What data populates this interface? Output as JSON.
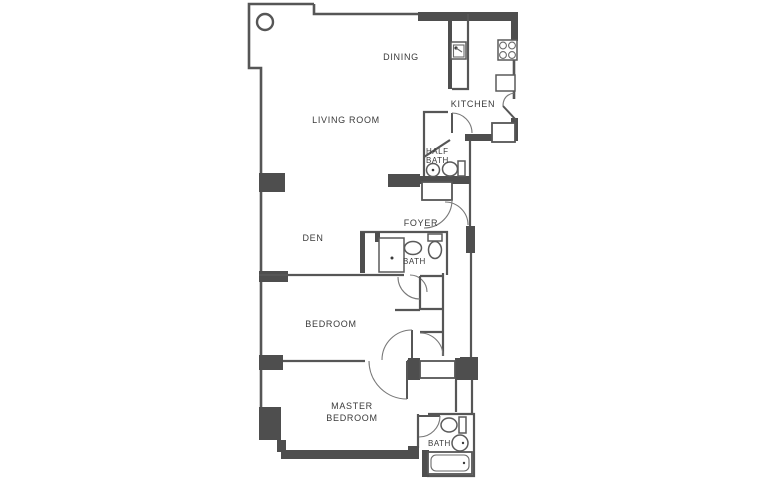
{
  "figure": "apartment-floor-plan",
  "colors": {
    "background": "#ffffff",
    "wall_dark": "#4e4e4e",
    "wall_line": "#565656",
    "door_arc": "#787878",
    "label_text": "#3a3a3a"
  },
  "rooms": {
    "dining": {
      "label": "DINING"
    },
    "kitchen": {
      "label": "KITCHEN"
    },
    "living_room": {
      "label": "LIVING ROOM"
    },
    "half_bath": {
      "label_line1": "HALF",
      "label_line2": "BATH"
    },
    "foyer": {
      "label": "FOYER"
    },
    "den": {
      "label": "DEN"
    },
    "bath": {
      "label": "BATH"
    },
    "bedroom": {
      "label": "BEDROOM"
    },
    "master_bedroom": {
      "label_line1": "MASTER",
      "label_line2": "BEDROOM"
    },
    "master_bath": {
      "label": "BATH"
    }
  },
  "fixtures": {
    "kitchen": [
      "island-counter",
      "kitchen-sink",
      "range-burners",
      "base-counter"
    ],
    "half_bath": [
      "sink",
      "toilet"
    ],
    "bath": [
      "shower",
      "sink",
      "toilet"
    ],
    "master_bath": [
      "toilet",
      "sink",
      "bathtub"
    ],
    "structure": [
      "round-column",
      "wall-pilasters",
      "entry-door",
      "closets"
    ]
  }
}
